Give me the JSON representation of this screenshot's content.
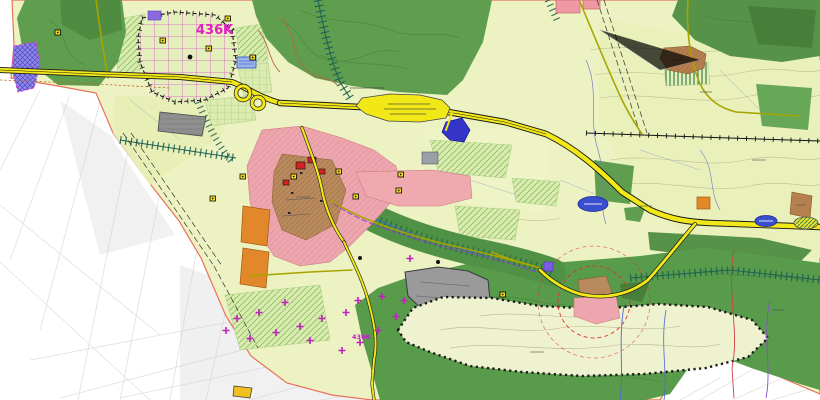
{
  "map": {
    "title": "zoning-plan-map",
    "labels": {
      "zone_main": "436K",
      "zone_small": "436K"
    },
    "colors": {
      "plan_base": "#ecf2c2",
      "field_alt": "#e7efb6",
      "meadow_hatch": "#d9ecae",
      "forest": "#5f9e4f",
      "forest_dark": "#4f8c42",
      "valley_forest": "#4f9145",
      "residential_pink": "#eda6ad",
      "village_core_brown": "#ba8a5f",
      "industrial_gray": "#8f8f8f",
      "quarry_gray": "#9a9a9a",
      "road_yellow": "#f2e818",
      "minor_road_olive": "#a8a400",
      "orange_zone": "#e2882a",
      "water_blue": "#3a4fd0",
      "violet_zone": "#8f86e8",
      "special_magenta": "#e020c0",
      "plan_boundary": "#e8715c",
      "corridor_teal": "#1d6152",
      "outside_white": "#ffffff"
    }
  }
}
